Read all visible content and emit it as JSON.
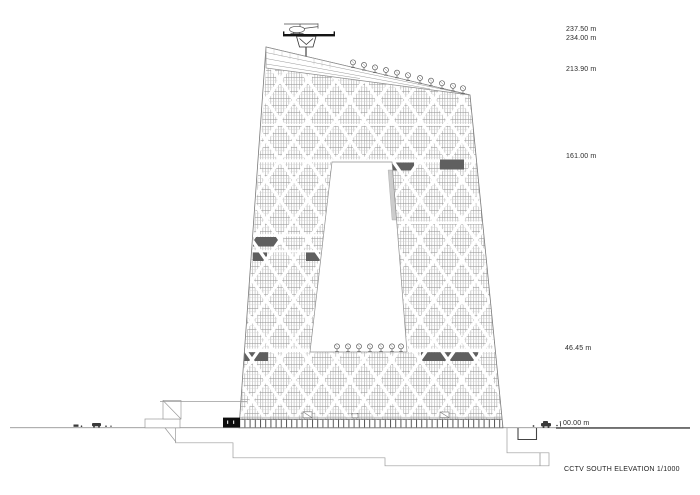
{
  "drawing": {
    "caption": "CCTV SOUTH ELEVATION 1/1000",
    "levels": [
      {
        "label": "237.50 m"
      },
      {
        "label": "234.00 m"
      },
      {
        "label": "213.90 m"
      },
      {
        "label": "161.00 m"
      },
      {
        "label": "46.45 m"
      },
      {
        "label": "00.00 m"
      }
    ],
    "colors": {
      "ink": "#2b2b2b",
      "facade_line": "#9a9a9a",
      "diagrid_band": "#ffffff",
      "dark_panel": "#5f5f5f",
      "entrance_block": "#0d0d0d",
      "ground_line": "#7d7d7d"
    },
    "icons": {
      "helicopter": "helicopter-icon",
      "helipad": "helipad-icon",
      "satellite_dish": "satellite-dish-icon",
      "car": "car-icon"
    }
  }
}
